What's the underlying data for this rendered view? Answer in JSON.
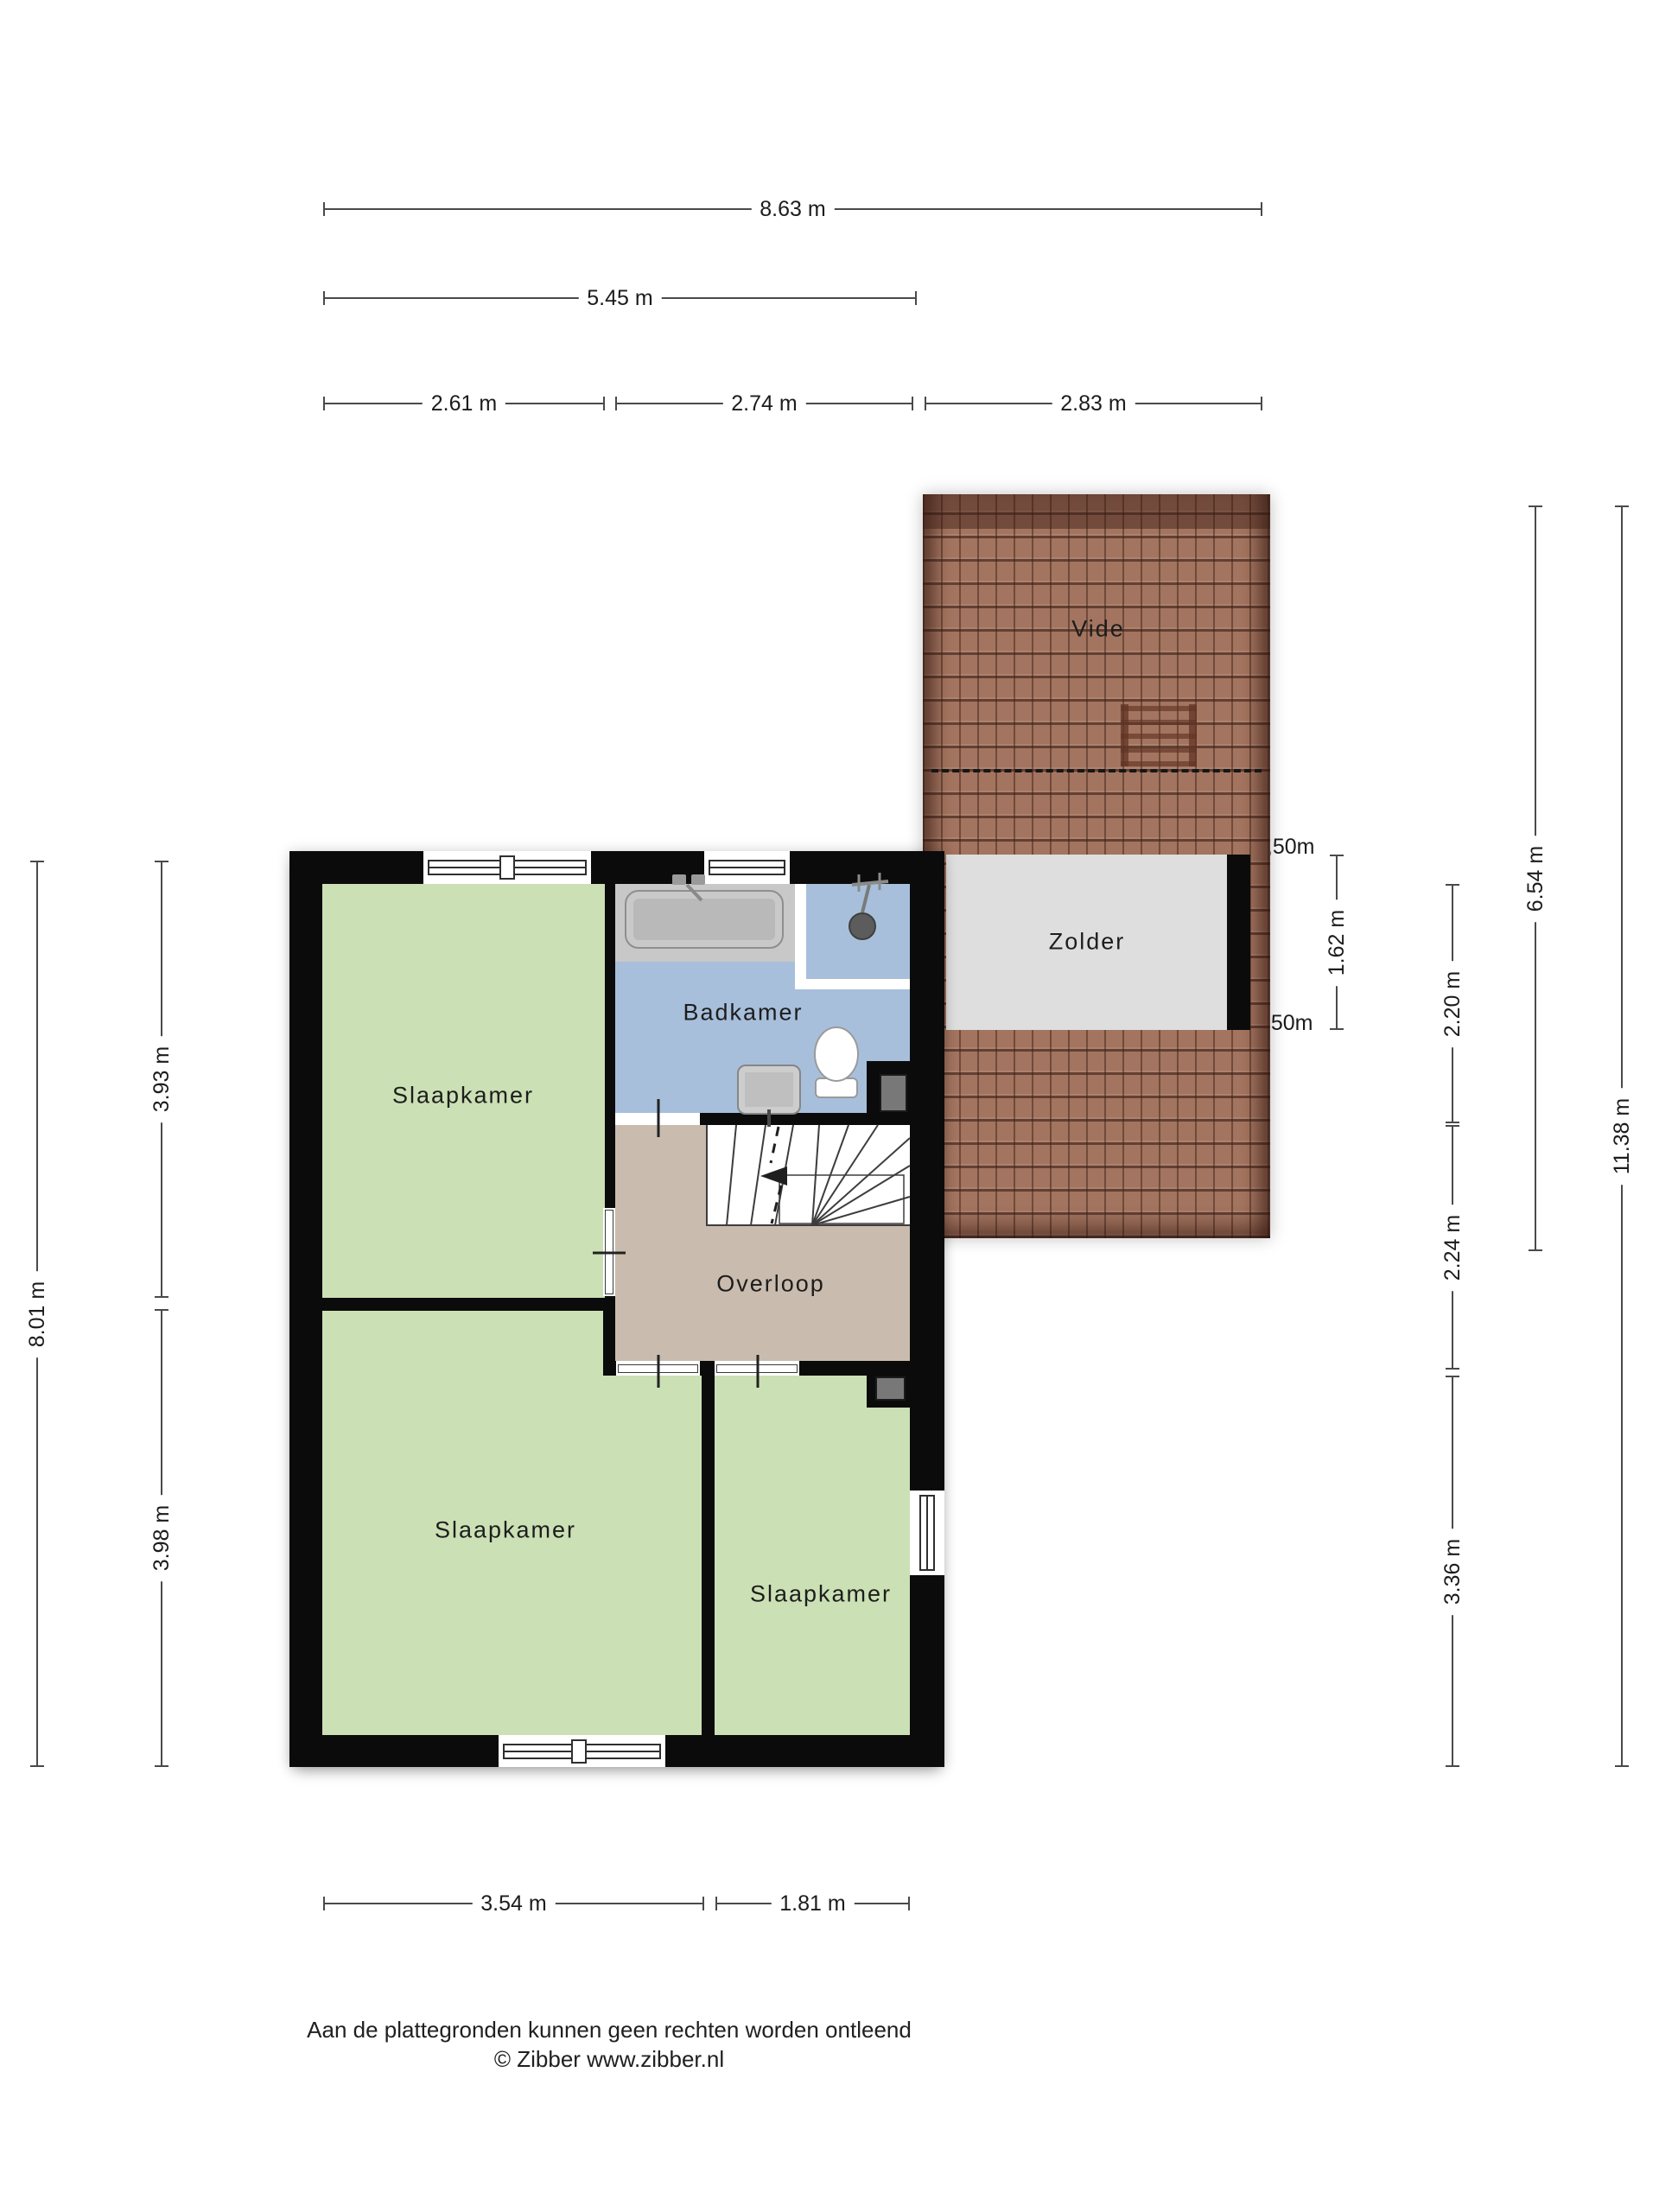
{
  "rooms": {
    "vide": "Vide",
    "zolder": "Zolder",
    "badkamer": "Badkamer",
    "overloop": "Overloop",
    "slaapkamer_top": "Slaapkamer",
    "slaapkamer_bottom_left": "Slaapkamer",
    "slaapkamer_bottom_right": "Slaapkamer"
  },
  "dimensions": {
    "top": [
      "8.63 m",
      "5.45 m",
      "2.61 m",
      "2.74 m",
      "2.83 m"
    ],
    "left": [
      "8.01 m",
      "3.93 m",
      "3.98 m"
    ],
    "right": [
      "1.62 m",
      "2.20 m",
      "2.24 m",
      "3.36 m",
      "6.54 m",
      "11.38 m"
    ],
    "bottom": [
      "3.54 m",
      "1.81 m"
    ],
    "knee_wall_top": "1,50m",
    "knee_wall_bottom": "1,50m"
  },
  "footer": {
    "disclaimer": "Aan de plattegronden kunnen geen rechten worden ontleend",
    "copyright": "© Zibber www.zibber.nl"
  },
  "colors": {
    "room_green": "#cbe0b4",
    "room_blue": "#a7bfdb",
    "room_tan": "#c9bcae",
    "zolder_gray": "#dedede",
    "roof_tile": "#a3745f",
    "wall_black": "#0b0b0b",
    "dim_line": "#4a4a4a"
  }
}
